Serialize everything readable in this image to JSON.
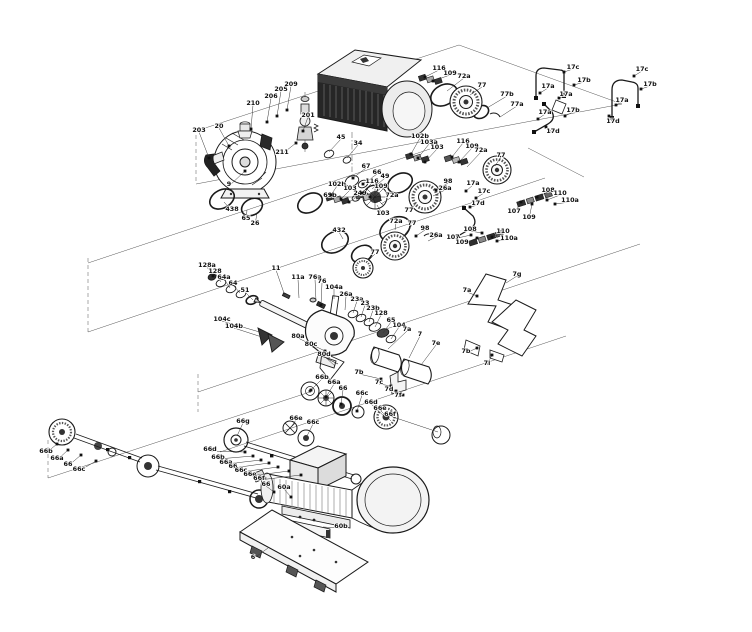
{
  "diagram": {
    "type": "exploded-parts-diagram",
    "subject": "multistage pump with motor, shaft seal assemblies, couplings and base plate",
    "background": "#ffffff",
    "line_color": "#1a1a1a",
    "label_color": "#111111",
    "labels": [
      {
        "t": "203",
        "x": 199,
        "y": 130,
        "tx": 209,
        "ty": 158,
        "d": 1
      },
      {
        "t": "20",
        "x": 219,
        "y": 126,
        "tx": 229,
        "ty": 146,
        "d": 1
      },
      {
        "t": "210",
        "x": 253,
        "y": 103,
        "tx": 251,
        "ty": 129,
        "d": 1
      },
      {
        "t": "206",
        "x": 271,
        "y": 96,
        "tx": 267,
        "ty": 122,
        "d": 1
      },
      {
        "t": "205",
        "x": 281,
        "y": 89,
        "tx": 277,
        "ty": 116,
        "d": 1
      },
      {
        "t": "209",
        "x": 291,
        "y": 84,
        "tx": 287,
        "ty": 110,
        "d": 1
      },
      {
        "t": "201",
        "x": 308,
        "y": 115,
        "tx": 303,
        "ty": 131,
        "d": 1
      },
      {
        "t": "211",
        "x": 282,
        "y": 152,
        "tx": 296,
        "ty": 143,
        "d": 1
      },
      {
        "t": "9",
        "x": 229,
        "y": 184,
        "tx": 245,
        "ty": 171,
        "d": 1
      },
      {
        "t": "438",
        "x": 232,
        "y": 209,
        "tx": 224,
        "ty": 202,
        "d": 0
      },
      {
        "t": "65",
        "x": 246,
        "y": 218,
        "tx": 247,
        "ty": 210,
        "d": 0
      },
      {
        "t": "26",
        "x": 255,
        "y": 223,
        "tx": 257,
        "ty": 213,
        "d": 0
      },
      {
        "t": "45",
        "x": 341,
        "y": 137,
        "tx": 329,
        "ty": 152,
        "d": 0
      },
      {
        "t": "34",
        "x": 358,
        "y": 143,
        "tx": 347,
        "ty": 158,
        "d": 0
      },
      {
        "t": "67",
        "x": 366,
        "y": 166,
        "tx": 353,
        "ty": 178,
        "d": 1
      },
      {
        "t": "66",
        "x": 377,
        "y": 172,
        "tx": 363,
        "ty": 184,
        "d": 1
      },
      {
        "t": "49",
        "x": 385,
        "y": 176,
        "tx": 372,
        "ty": 189,
        "d": 0
      },
      {
        "t": "69b",
        "x": 330,
        "y": 195,
        "tx": 355,
        "ty": 197,
        "d": 0
      },
      {
        "t": "103",
        "x": 383,
        "y": 213,
        "tx": 377,
        "ty": 205,
        "d": 0
      },
      {
        "t": "72a",
        "x": 396,
        "y": 221,
        "tx": 395,
        "ty": 230,
        "d": 0
      },
      {
        "t": "102b",
        "x": 420,
        "y": 136,
        "tx": 411,
        "ty": 154,
        "d": 1
      },
      {
        "t": "103a",
        "x": 429,
        "y": 142,
        "tx": 418,
        "ty": 158,
        "d": 1
      },
      {
        "t": "103",
        "x": 437,
        "y": 147,
        "tx": 425,
        "ty": 162,
        "d": 1
      },
      {
        "t": "116",
        "x": 439,
        "y": 68,
        "tx": 425,
        "ty": 77,
        "d": 1
      },
      {
        "t": "109",
        "x": 450,
        "y": 73,
        "tx": 433,
        "ty": 81,
        "d": 1
      },
      {
        "t": "72a",
        "x": 464,
        "y": 76,
        "tx": 447,
        "ty": 91,
        "d": 0
      },
      {
        "t": "77",
        "x": 482,
        "y": 85,
        "tx": 470,
        "ty": 95,
        "d": 0
      },
      {
        "t": "77b",
        "x": 507,
        "y": 94,
        "tx": 487,
        "ty": 108,
        "d": 0
      },
      {
        "t": "77a",
        "x": 517,
        "y": 104,
        "tx": 500,
        "ty": 117,
        "d": 0
      },
      {
        "t": "17c",
        "x": 573,
        "y": 67,
        "tx": 564,
        "ty": 72,
        "d": 1
      },
      {
        "t": "17a",
        "x": 548,
        "y": 86,
        "tx": 540,
        "ty": 93,
        "d": 1
      },
      {
        "t": "17b",
        "x": 584,
        "y": 80,
        "tx": 574,
        "ty": 85,
        "d": 1
      },
      {
        "t": "17a",
        "x": 566,
        "y": 94,
        "tx": 559,
        "ty": 98,
        "d": 1
      },
      {
        "t": "17c",
        "x": 642,
        "y": 69,
        "tx": 634,
        "ty": 76,
        "d": 1
      },
      {
        "t": "17b",
        "x": 650,
        "y": 84,
        "tx": 641,
        "ty": 89,
        "d": 1
      },
      {
        "t": "17a",
        "x": 622,
        "y": 100,
        "tx": 616,
        "ty": 105,
        "d": 1
      },
      {
        "t": "17d",
        "x": 613,
        "y": 121,
        "tx": 609,
        "ty": 116,
        "d": 1
      },
      {
        "t": "116",
        "x": 463,
        "y": 141,
        "tx": 452,
        "ty": 157,
        "d": 1
      },
      {
        "t": "109",
        "x": 472,
        "y": 146,
        "tx": 459,
        "ty": 162,
        "d": 1
      },
      {
        "t": "72a",
        "x": 481,
        "y": 150,
        "tx": 467,
        "ty": 167,
        "d": 0
      },
      {
        "t": "77",
        "x": 501,
        "y": 155,
        "tx": 495,
        "ty": 166,
        "d": 0
      },
      {
        "t": "98",
        "x": 448,
        "y": 181,
        "tx": 436,
        "ty": 190,
        "d": 1
      },
      {
        "t": "26a",
        "x": 445,
        "y": 188,
        "tx": 433,
        "ty": 196,
        "d": 0
      },
      {
        "t": "17a",
        "x": 545,
        "y": 112,
        "tx": 538,
        "ty": 119,
        "d": 1
      },
      {
        "t": "17b",
        "x": 573,
        "y": 110,
        "tx": 565,
        "ty": 116,
        "d": 1
      },
      {
        "t": "17d",
        "x": 553,
        "y": 131,
        "tx": 546,
        "ty": 127,
        "d": 1
      },
      {
        "t": "108",
        "x": 548,
        "y": 190,
        "tx": 537,
        "ty": 197,
        "d": 1
      },
      {
        "t": "110",
        "x": 560,
        "y": 193,
        "tx": 547,
        "ty": 200,
        "d": 1
      },
      {
        "t": "110a",
        "x": 570,
        "y": 200,
        "tx": 555,
        "ty": 204,
        "d": 1
      },
      {
        "t": "107",
        "x": 514,
        "y": 211,
        "tx": 521,
        "ty": 202,
        "d": 1
      },
      {
        "t": "109",
        "x": 529,
        "y": 217,
        "tx": 532,
        "ty": 204,
        "d": 1
      },
      {
        "t": "77",
        "x": 409,
        "y": 210,
        "tx": 417,
        "ty": 202,
        "d": 0
      },
      {
        "t": "432",
        "x": 339,
        "y": 230,
        "tx": 343,
        "ty": 239,
        "d": 0
      },
      {
        "t": "102b",
        "x": 337,
        "y": 184,
        "tx": 331,
        "ty": 195,
        "d": 1
      },
      {
        "t": "103",
        "x": 350,
        "y": 188,
        "tx": 341,
        "ty": 199,
        "d": 1
      },
      {
        "t": "249",
        "x": 360,
        "y": 193,
        "tx": 349,
        "ty": 202,
        "d": 1
      },
      {
        "t": "116",
        "x": 372,
        "y": 181,
        "tx": 362,
        "ty": 193,
        "d": 1
      },
      {
        "t": "109",
        "x": 381,
        "y": 186,
        "tx": 370,
        "ty": 197,
        "d": 1
      },
      {
        "t": "72a",
        "x": 392,
        "y": 195,
        "tx": 381,
        "ty": 204,
        "d": 0
      },
      {
        "t": "77",
        "x": 412,
        "y": 223,
        "tx": 402,
        "ty": 238,
        "d": 0
      },
      {
        "t": "98",
        "x": 425,
        "y": 228,
        "tx": 416,
        "ty": 236,
        "d": 1
      },
      {
        "t": "26a",
        "x": 436,
        "y": 235,
        "tx": 428,
        "ty": 241,
        "d": 0
      },
      {
        "t": "77",
        "x": 375,
        "y": 252,
        "tx": 367,
        "ty": 262,
        "d": 0
      },
      {
        "t": "17a",
        "x": 473,
        "y": 183,
        "tx": 466,
        "ty": 191,
        "d": 1
      },
      {
        "t": "17c",
        "x": 484,
        "y": 191,
        "tx": 476,
        "ty": 198,
        "d": 1
      },
      {
        "t": "17d",
        "x": 478,
        "y": 203,
        "tx": 470,
        "ty": 207,
        "d": 1
      },
      {
        "t": "107",
        "x": 453,
        "y": 237,
        "tx": 471,
        "ty": 235,
        "d": 1
      },
      {
        "t": "109",
        "x": 462,
        "y": 242,
        "tx": 477,
        "ty": 238,
        "d": 1
      },
      {
        "t": "108",
        "x": 470,
        "y": 229,
        "tx": 482,
        "ty": 233,
        "d": 1
      },
      {
        "t": "110",
        "x": 503,
        "y": 231,
        "tx": 492,
        "ty": 237,
        "d": 1
      },
      {
        "t": "110a",
        "x": 509,
        "y": 238,
        "tx": 497,
        "ty": 241,
        "d": 1
      },
      {
        "t": "128a",
        "x": 207,
        "y": 265,
        "tx": 213,
        "ty": 276,
        "d": 1
      },
      {
        "t": "128",
        "x": 215,
        "y": 271,
        "tx": 221,
        "ty": 282,
        "d": 0
      },
      {
        "t": "64a",
        "x": 224,
        "y": 277,
        "tx": 230,
        "ty": 288,
        "d": 0
      },
      {
        "t": "64",
        "x": 233,
        "y": 283,
        "tx": 240,
        "ty": 293,
        "d": 0
      },
      {
        "t": "51",
        "x": 245,
        "y": 290,
        "tx": 253,
        "ty": 300,
        "d": 0
      },
      {
        "t": "11",
        "x": 276,
        "y": 268,
        "tx": 285,
        "ty": 296,
        "d": 0
      },
      {
        "t": "11a",
        "x": 298,
        "y": 277,
        "tx": 299,
        "ty": 298,
        "d": 0
      },
      {
        "t": "76a",
        "x": 315,
        "y": 277,
        "tx": 316,
        "ty": 301,
        "d": 0
      },
      {
        "t": "76",
        "x": 322,
        "y": 281,
        "tx": 321,
        "ty": 305,
        "d": 1
      },
      {
        "t": "104a",
        "x": 334,
        "y": 287,
        "tx": 334,
        "ty": 299,
        "d": 0
      },
      {
        "t": "104c",
        "x": 222,
        "y": 319,
        "tx": 263,
        "ty": 333,
        "d": 0
      },
      {
        "t": "104b",
        "x": 234,
        "y": 326,
        "tx": 268,
        "ty": 339,
        "d": 0
      },
      {
        "t": "26a",
        "x": 346,
        "y": 294,
        "tx": 345,
        "ty": 310,
        "d": 0
      },
      {
        "t": "23a",
        "x": 357,
        "y": 299,
        "tx": 353,
        "ty": 313,
        "d": 0
      },
      {
        "t": "23",
        "x": 365,
        "y": 303,
        "tx": 361,
        "ty": 317,
        "d": 0
      },
      {
        "t": "23b",
        "x": 373,
        "y": 308,
        "tx": 369,
        "ty": 322,
        "d": 0
      },
      {
        "t": "128",
        "x": 381,
        "y": 313,
        "tx": 375,
        "ty": 327,
        "d": 0
      },
      {
        "t": "65",
        "x": 391,
        "y": 320,
        "tx": 383,
        "ty": 333,
        "d": 0
      },
      {
        "t": "104",
        "x": 399,
        "y": 325,
        "tx": 391,
        "ty": 339,
        "d": 0
      },
      {
        "t": "80a",
        "x": 298,
        "y": 336,
        "tx": 325,
        "ty": 351,
        "d": 1
      },
      {
        "t": "80c",
        "x": 311,
        "y": 344,
        "tx": 330,
        "ty": 358,
        "d": 0
      },
      {
        "t": "80d",
        "x": 324,
        "y": 354,
        "tx": 335,
        "ty": 366,
        "d": 0
      },
      {
        "t": "7a",
        "x": 407,
        "y": 329,
        "tx": 388,
        "ty": 349,
        "d": 0
      },
      {
        "t": "7",
        "x": 420,
        "y": 334,
        "tx": 409,
        "ty": 358,
        "d": 0
      },
      {
        "t": "7e",
        "x": 436,
        "y": 343,
        "tx": 421,
        "ty": 365,
        "d": 0
      },
      {
        "t": "7b",
        "x": 359,
        "y": 372,
        "tx": 381,
        "ty": 379,
        "d": 1
      },
      {
        "t": "7c",
        "x": 379,
        "y": 382,
        "tx": 391,
        "ty": 386,
        "d": 1
      },
      {
        "t": "7d",
        "x": 389,
        "y": 389,
        "tx": 396,
        "ty": 391,
        "d": 1
      },
      {
        "t": "7f",
        "x": 398,
        "y": 395,
        "tx": 403,
        "ty": 395,
        "d": 1
      },
      {
        "t": "7g",
        "x": 517,
        "y": 274,
        "tx": 506,
        "ty": 283,
        "d": 0
      },
      {
        "t": "7a",
        "x": 467,
        "y": 290,
        "tx": 477,
        "ty": 296,
        "d": 1
      },
      {
        "t": "7b",
        "x": 466,
        "y": 351,
        "tx": 477,
        "ty": 348,
        "d": 1
      },
      {
        "t": "7i",
        "x": 487,
        "y": 363,
        "tx": 492,
        "ty": 355,
        "d": 1
      },
      {
        "t": "66b",
        "x": 322,
        "y": 377,
        "tx": 311,
        "ty": 390,
        "d": 1
      },
      {
        "t": "66a",
        "x": 334,
        "y": 382,
        "tx": 326,
        "ty": 397,
        "d": 1
      },
      {
        "t": "66",
        "x": 343,
        "y": 388,
        "tx": 341,
        "ty": 404,
        "d": 1
      },
      {
        "t": "66c",
        "x": 362,
        "y": 393,
        "tx": 357,
        "ty": 411,
        "d": 1
      },
      {
        "t": "66d",
        "x": 371,
        "y": 402,
        "tx": 385,
        "ty": 417,
        "d": 0
      },
      {
        "t": "66e",
        "x": 380,
        "y": 408,
        "tx": 391,
        "ty": 421,
        "d": 0
      },
      {
        "t": "66f",
        "x": 390,
        "y": 414,
        "tx": 438,
        "ty": 432,
        "d": 0
      },
      {
        "t": "66e",
        "x": 296,
        "y": 418,
        "tx": 291,
        "ty": 427,
        "d": 0
      },
      {
        "t": "66c",
        "x": 313,
        "y": 422,
        "tx": 307,
        "ty": 436,
        "d": 0
      },
      {
        "t": "66g",
        "x": 243,
        "y": 421,
        "tx": 237,
        "ty": 436,
        "d": 0
      },
      {
        "t": "66d",
        "x": 210,
        "y": 449,
        "tx": 245,
        "ty": 452,
        "d": 1
      },
      {
        "t": "66b",
        "x": 218,
        "y": 457,
        "tx": 253,
        "ty": 456,
        "d": 1
      },
      {
        "t": "66a",
        "x": 226,
        "y": 462,
        "tx": 261,
        "ty": 460,
        "d": 1
      },
      {
        "t": "66",
        "x": 233,
        "y": 466,
        "tx": 269,
        "ty": 463,
        "d": 1
      },
      {
        "t": "66c",
        "x": 241,
        "y": 470,
        "tx": 278,
        "ty": 467,
        "d": 1
      },
      {
        "t": "66e",
        "x": 250,
        "y": 474,
        "tx": 289,
        "ty": 471,
        "d": 1
      },
      {
        "t": "66f",
        "x": 259,
        "y": 478,
        "tx": 301,
        "ty": 475,
        "d": 1
      },
      {
        "t": "66b",
        "x": 46,
        "y": 451,
        "tx": 57,
        "ty": 444,
        "d": 1
      },
      {
        "t": "66a",
        "x": 57,
        "y": 458,
        "tx": 68,
        "ty": 450,
        "d": 1
      },
      {
        "t": "66",
        "x": 68,
        "y": 464,
        "tx": 81,
        "ty": 455,
        "d": 1
      },
      {
        "t": "66c",
        "x": 79,
        "y": 469,
        "tx": 96,
        "ty": 461,
        "d": 1
      },
      {
        "t": "66",
        "x": 266,
        "y": 484,
        "tx": 274,
        "ty": 492,
        "d": 1
      },
      {
        "t": "60a",
        "x": 284,
        "y": 487,
        "tx": 291,
        "ty": 497,
        "d": 1
      },
      {
        "t": "60b",
        "x": 341,
        "y": 526,
        "tx": 323,
        "ty": 527,
        "d": 0
      },
      {
        "t": "6",
        "x": 253,
        "y": 557,
        "tx": 268,
        "ty": 548,
        "d": 0
      }
    ]
  }
}
